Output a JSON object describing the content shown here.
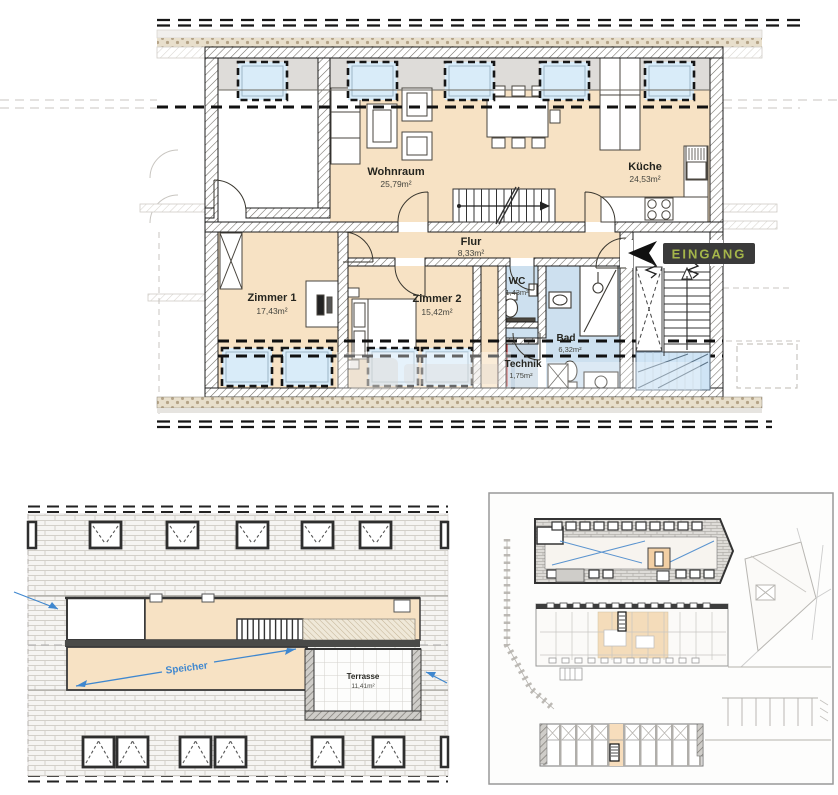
{
  "floor_plan": {
    "entrance_badge": "EINGANG",
    "rooms": {
      "wohnraum": {
        "name": "Wohnraum",
        "area": "25,79m²"
      },
      "kueche": {
        "name": "Küche",
        "area": "24,53m²"
      },
      "flur": {
        "name": "Flur",
        "area": "8,33m²"
      },
      "zimmer1": {
        "name": "Zimmer 1",
        "area": "17,43m²"
      },
      "zimmer2": {
        "name": "Zimmer 2",
        "area": "15,42m²"
      },
      "wc": {
        "name": "WC",
        "area": "1,43m²"
      },
      "bad": {
        "name": "Bad",
        "area": "6,32m²"
      },
      "technik": {
        "name": "Technik",
        "area": "1,75m²"
      }
    }
  },
  "attic_plan": {
    "speicher_label": "Speicher",
    "terrasse": {
      "name": "Terrasse",
      "area": "11,41m²"
    }
  },
  "colors": {
    "room_fill": "#f7e2c4",
    "wet_room_fill": "#cde0ef",
    "skylight_fill": "#d9ecf9",
    "roof_gray": "#dedcd9",
    "badge_background": "#3a3a3a",
    "badge_text": "#a4b54a",
    "annotation_blue": "#3f87cf",
    "technik_red": "#d24a4a"
  }
}
